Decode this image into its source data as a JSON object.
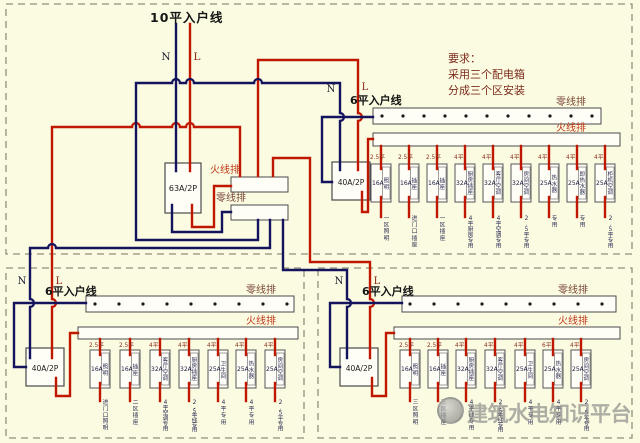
{
  "title": "10平入户线",
  "requirements": {
    "line1": "要求：",
    "line2": "采用三个配电箱",
    "line3": "分成三个区安装"
  },
  "watermark": "建筑水电知识平台",
  "incoming": {
    "n": "N",
    "l": "L"
  },
  "main_box": {
    "breaker": "63A/2P",
    "live_bus": "火线排",
    "neutral_bus": "零线排"
  },
  "colors": {
    "live": "#c01800",
    "neutral": "#14145e",
    "background": "#fbfbe2",
    "bus_label_live": "#bf3617",
    "bus_label_neutral": "#7a4535"
  },
  "sub_boxes": [
    {
      "id": "zone1",
      "feeder": "6平入户线",
      "n": "N",
      "l": "L",
      "neutral_bus": "零线排",
      "live_bus": "火线排",
      "main_breaker": "40A/2P",
      "breakers": [
        {
          "amp": "16A",
          "wire": "2.5平",
          "name": "照明",
          "circuit": "一区照明"
        },
        {
          "amp": "16A",
          "wire": "2.5平",
          "name": "插座",
          "circuit": "进门口插座"
        },
        {
          "amp": "16A",
          "wire": "2.5平",
          "name": "插座",
          "circuit": "一区插座"
        },
        {
          "amp": "32A",
          "wire": "4平",
          "name": "厨房插座",
          "circuit": "4平厨房专用"
        },
        {
          "amp": "32A",
          "wire": "4平",
          "name": "客厅空调",
          "circuit": "4平空调专用"
        },
        {
          "amp": "32A",
          "wire": "4平",
          "name": "房间空调",
          "circuit": "2.5平专用"
        },
        {
          "amp": "25A",
          "wire": "4平",
          "name": "热水器",
          "circuit": "专用"
        },
        {
          "amp": "25A",
          "wire": "4平",
          "name": "即热水器",
          "circuit": "专用"
        },
        {
          "amp": "25A",
          "wire": "4平",
          "name": "柜机空调",
          "circuit": "2.5平专用"
        }
      ]
    },
    {
      "id": "zone2",
      "feeder": "6平入户线",
      "n": "N",
      "l": "L",
      "neutral_bus": "零线排",
      "live_bus": "火线排",
      "main_breaker": "40A/2P",
      "breakers": [
        {
          "amp": "16A",
          "wire": "2.5平",
          "name": "照明",
          "circuit": "进门口照明"
        },
        {
          "amp": "16A",
          "wire": "2.5平",
          "name": "插座",
          "circuit": "二区插座"
        },
        {
          "amp": "32A",
          "wire": "4平",
          "name": "客厅空调",
          "circuit": "4平空调专用"
        },
        {
          "amp": "32A",
          "wire": "4平",
          "name": "厨房插座",
          "circuit": "2.5平线专用"
        },
        {
          "amp": "25A",
          "wire": "4平",
          "name": "卫生间",
          "circuit": "4平专用"
        },
        {
          "amp": "25A",
          "wire": "4平",
          "name": "热水器",
          "circuit": "4平专用"
        },
        {
          "amp": "25A",
          "wire": "4平",
          "name": "房间空调",
          "circuit": "2.5平专用"
        }
      ]
    },
    {
      "id": "zone3",
      "feeder": "6平入户线",
      "n": "N",
      "l": "L",
      "neutral_bus": "零线排",
      "live_bus": "火线排",
      "main_breaker": "40A/2P",
      "breakers": [
        {
          "amp": "16A",
          "wire": "2.5平",
          "name": "照明",
          "circuit": "三区照明"
        },
        {
          "amp": "16A",
          "wire": "2.5平",
          "name": "插座",
          "circuit": "三区插座"
        },
        {
          "amp": "32A",
          "wire": "4平",
          "name": "厨房插座",
          "circuit": "4平线专用"
        },
        {
          "amp": "32A",
          "wire": "4平",
          "name": "客厅空调",
          "circuit": "2.5平线专用"
        },
        {
          "amp": "25A",
          "wire": "4平",
          "name": "卫生间",
          "circuit": "4平专用"
        },
        {
          "amp": "25A",
          "wire": "6平",
          "name": "热水器",
          "circuit": "4平专用"
        },
        {
          "amp": "25A",
          "wire": "4平",
          "name": "房间空调",
          "circuit": "2.5平专用"
        }
      ]
    }
  ]
}
